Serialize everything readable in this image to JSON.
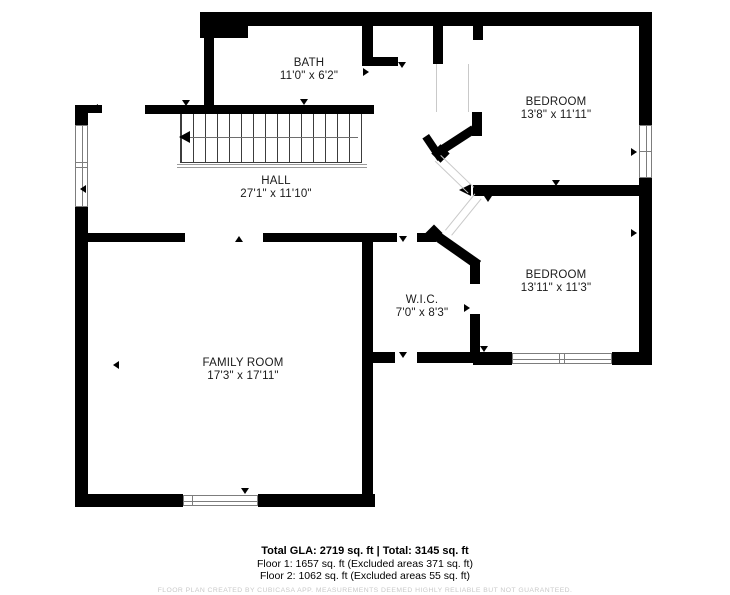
{
  "plan": {
    "rooms": [
      {
        "id": "bath",
        "name": "BATH",
        "dims": "11'0\" x 6'2\""
      },
      {
        "id": "bedroom1",
        "name": "BEDROOM",
        "dims": "13'8\" x 11'11\""
      },
      {
        "id": "hall",
        "name": "HALL",
        "dims": "27'1\" x 11'10\""
      },
      {
        "id": "bedroom2",
        "name": "BEDROOM",
        "dims": "13'11\" x 11'3\""
      },
      {
        "id": "wic",
        "name": "W.I.C.",
        "dims": "7'0\" x 8'3\""
      },
      {
        "id": "family",
        "name": "FAMILY ROOM",
        "dims": "17'3\" x 17'11\""
      }
    ],
    "colors": {
      "wall": "#000000",
      "text": "#1a1a1a",
      "window_frame": "#7d7d7d",
      "disclaimer": "#c9c9c9"
    }
  },
  "footer": {
    "total": "Total GLA: 2719 sq. ft | Total: 3145 sq. ft",
    "floor1": "Floor 1: 1657 sq. ft (Excluded areas 371 sq. ft)",
    "floor2": "Floor 2: 1062 sq. ft (Excluded areas 55 sq. ft)",
    "disclaimer": "FLOOR PLAN CREATED BY CUBICASA APP. MEASUREMENTS DEEMED HIGHLY RELIABLE BUT NOT GUARANTEED."
  }
}
